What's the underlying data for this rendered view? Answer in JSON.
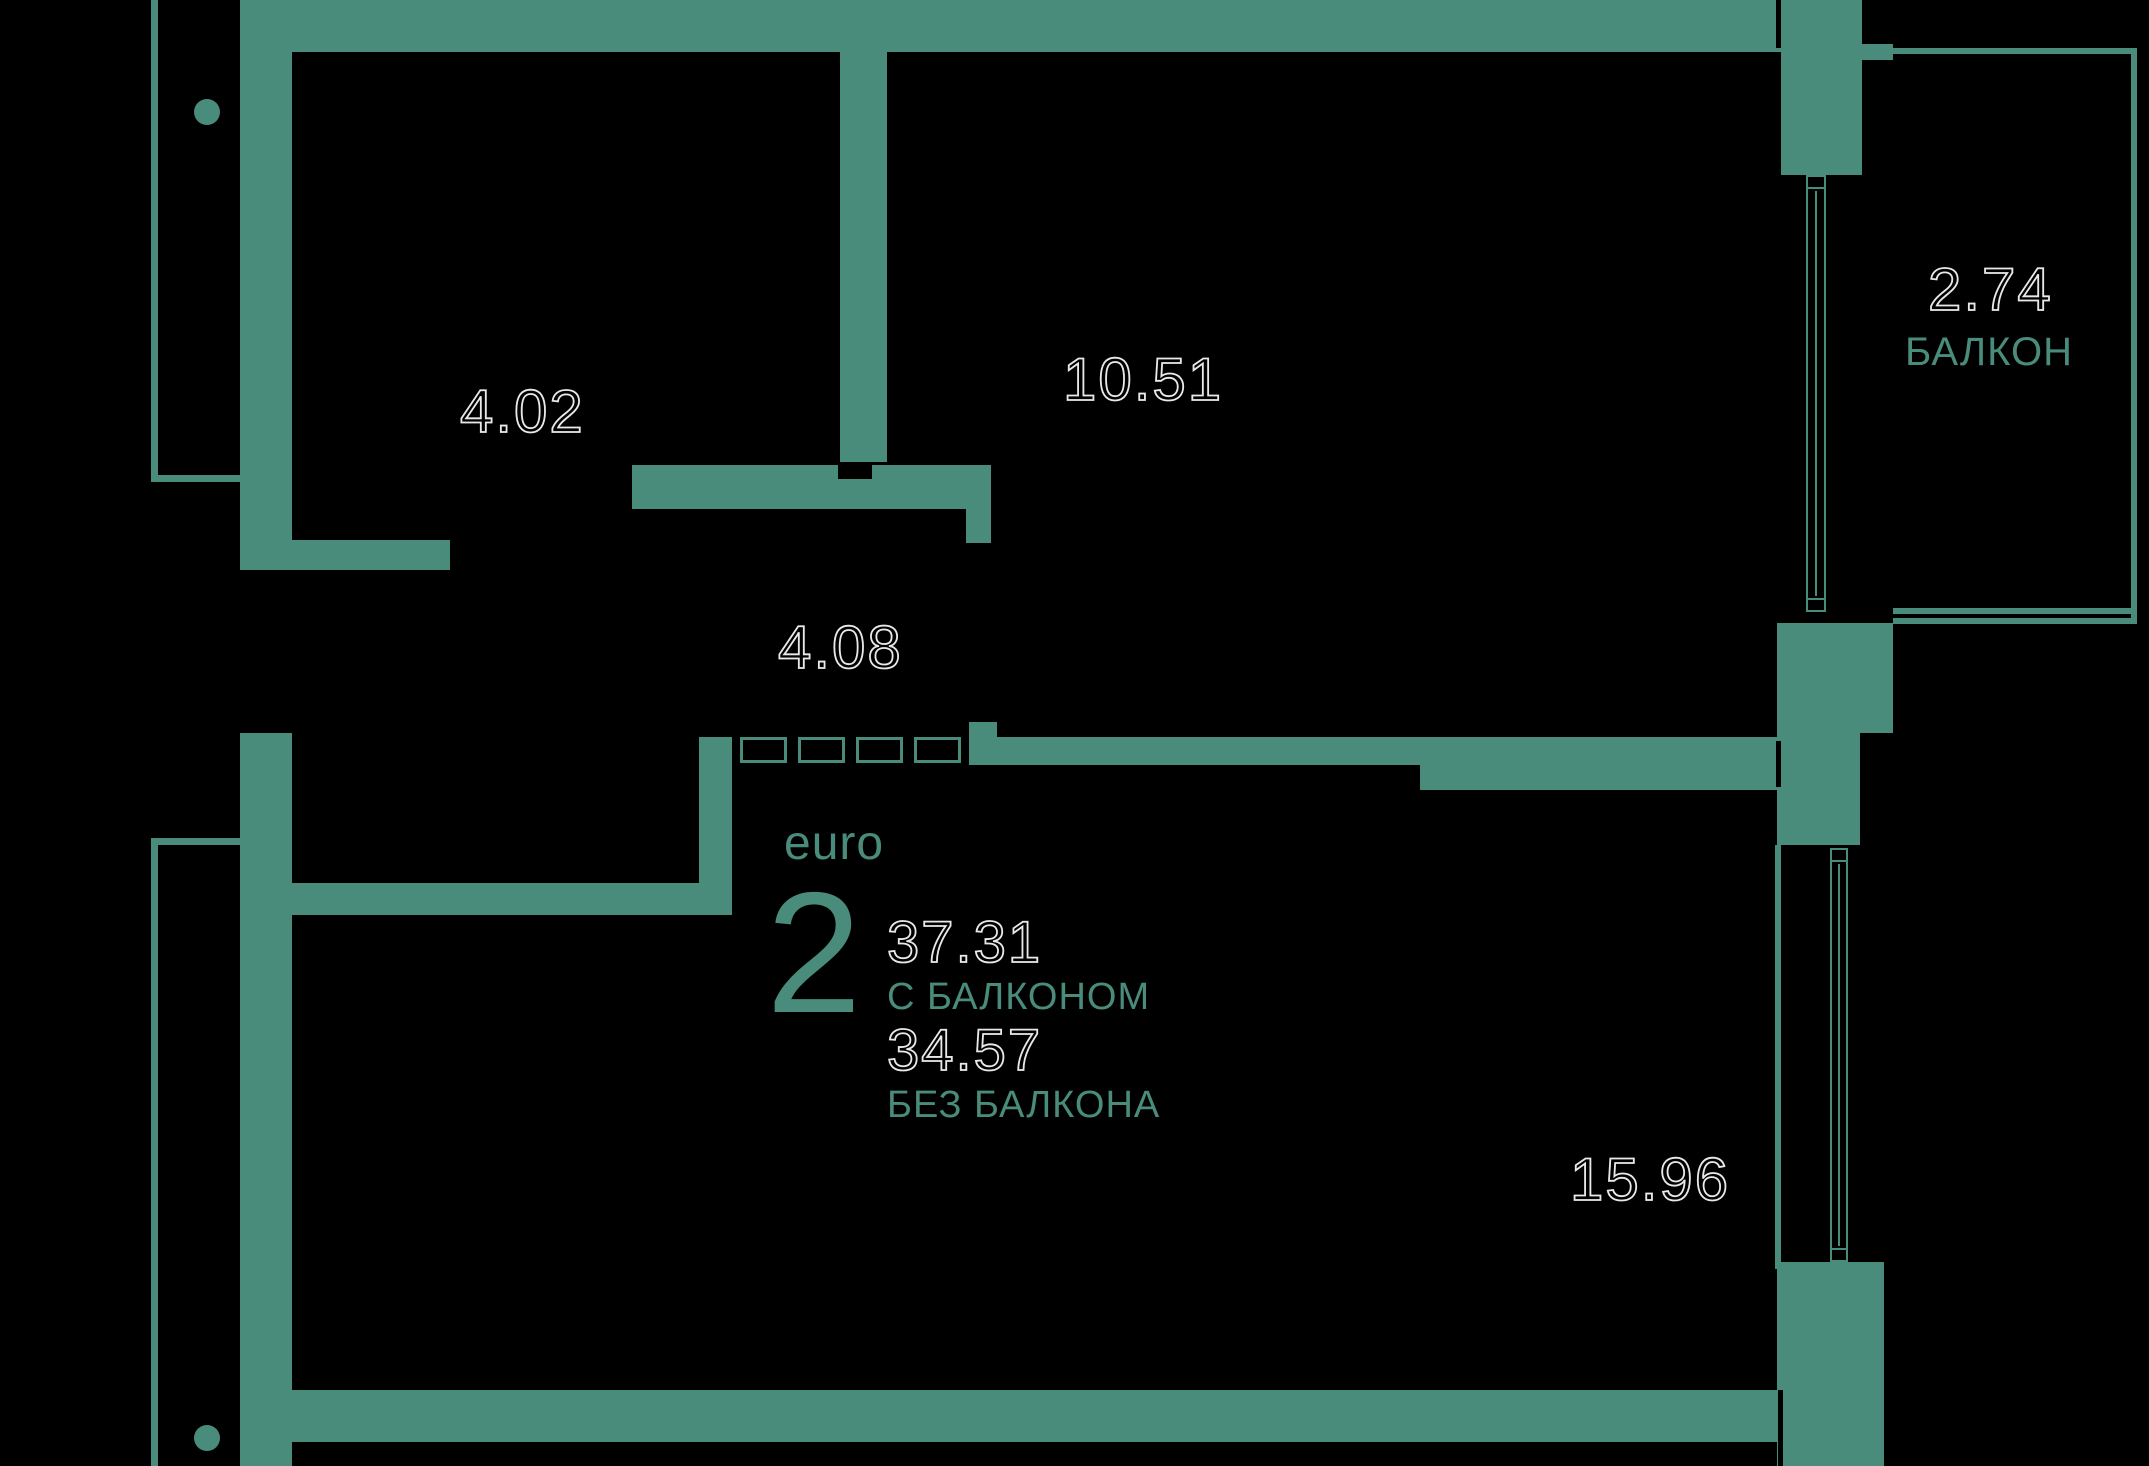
{
  "theme": {
    "background": "#000000",
    "wall_color": "#4a8c7b",
    "number_outline_color": "#e9e9e9"
  },
  "apartment": {
    "type_label": "euro",
    "rooms_count": "2",
    "area_with_balcony": "37.31",
    "with_balcony_label": "С БАЛКОНОМ",
    "area_without_balcony": "34.57",
    "without_balcony_label": "БЕЗ БАЛКОНА"
  },
  "rooms": {
    "room_top_left_area": "4.02",
    "room_top_middle_area": "10.51",
    "corridor_area": "4.08",
    "balcony_area": "2.74",
    "balcony_label": "БАЛКОН",
    "room_bottom_right_area": "15.96"
  }
}
